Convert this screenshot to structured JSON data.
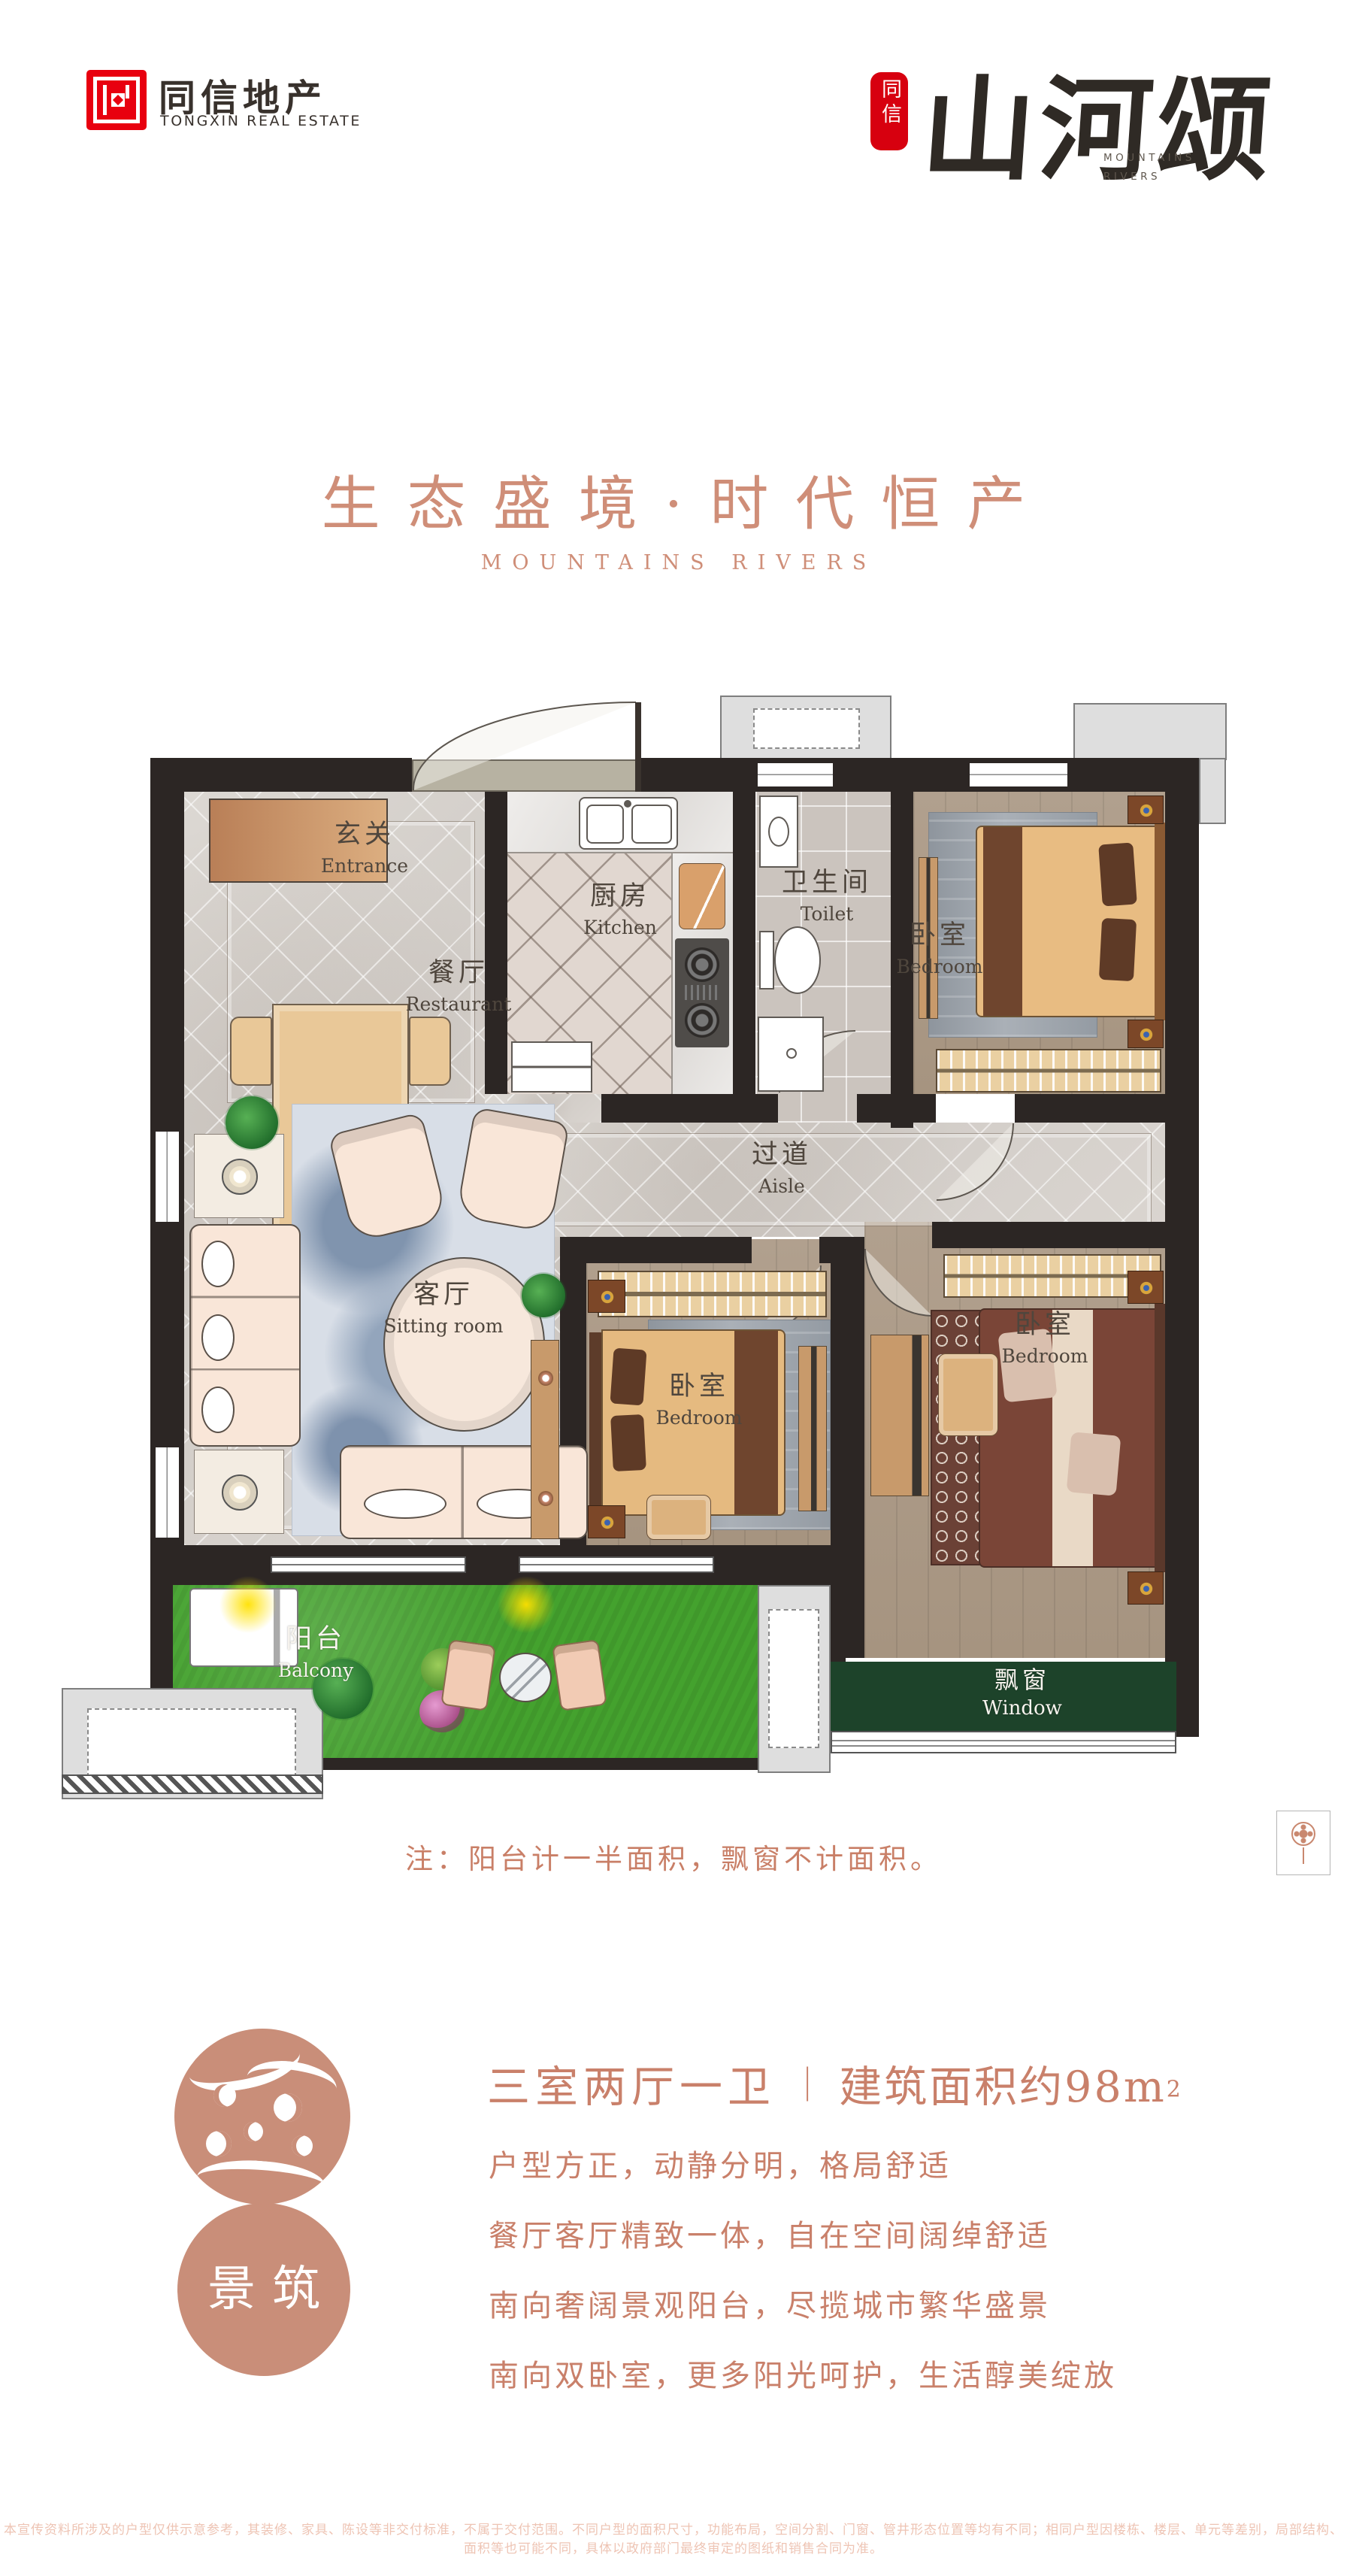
{
  "brand": {
    "left": {
      "name": "同信地产",
      "tagline": "TONGXIN REAL ESTATE"
    },
    "right": {
      "seal": "同信",
      "name": "山河颂",
      "sub_line1": "MOUNTAINS",
      "sub_line2": "RIVERS"
    }
  },
  "hero": {
    "title": "生态盛境·时代恒产",
    "subtitle": "MOUNTAINS RIVERS"
  },
  "floorplan": {
    "rooms": {
      "entrance": {
        "zh": "玄关",
        "en": "Entrance"
      },
      "restaurant": {
        "zh": "餐厅",
        "en": "Restaurant"
      },
      "kitchen": {
        "zh": "厨房",
        "en": "Kitchen"
      },
      "toilet": {
        "zh": "卫生间",
        "en": "Toilet"
      },
      "bedroom_top": {
        "zh": "卧室",
        "en": "Bedroom"
      },
      "aisle": {
        "zh": "过道",
        "en": "Aisle"
      },
      "sitting": {
        "zh": "客厅",
        "en": "Sitting room"
      },
      "bedroom_mid": {
        "zh": "卧室",
        "en": "Bedroom"
      },
      "bedroom_right": {
        "zh": "卧室",
        "en": "Bedroom"
      },
      "balcony": {
        "zh": "阳台",
        "en": "Balcony"
      },
      "bay_window": {
        "zh": "飘窗",
        "en": "Window"
      }
    },
    "note": "注：阳台计一半面积，飘窗不计面积。"
  },
  "details": {
    "stamp": "景筑",
    "headline": {
      "rooms": "三室两厅一卫",
      "divider": "｜",
      "area": "建筑面积约98m",
      "area_sup": "2"
    },
    "lines": [
      "户型方正，动静分明，格局舒适",
      "餐厅客厅精致一体，自在空间阔绰舒适",
      "南向奢阔景观阳台，尽揽城市繁华盛景",
      "南向双卧室，更多阳光呵护，生活醇美绽放"
    ]
  },
  "disclaimer": "本宣传资料所涉及的户型仅供示意参考，其装修、家具、陈设等非交付标准，不属于交付范围。不同户型的面积尺寸，功能布局，空间分割、门窗、管井形态位置等均有不同；相同户型因楼栋、楼层、单元等差别，局部结构、面积等也可能不同，具体以政府部门最终审定的图纸和销售合同为准。",
  "colors": {
    "accent": "#c9806a",
    "brand_red": "#e60012",
    "ink": "#332c27",
    "wall": "#2c2624",
    "grass": "#44a22e",
    "bay_green": "#1d432a"
  }
}
